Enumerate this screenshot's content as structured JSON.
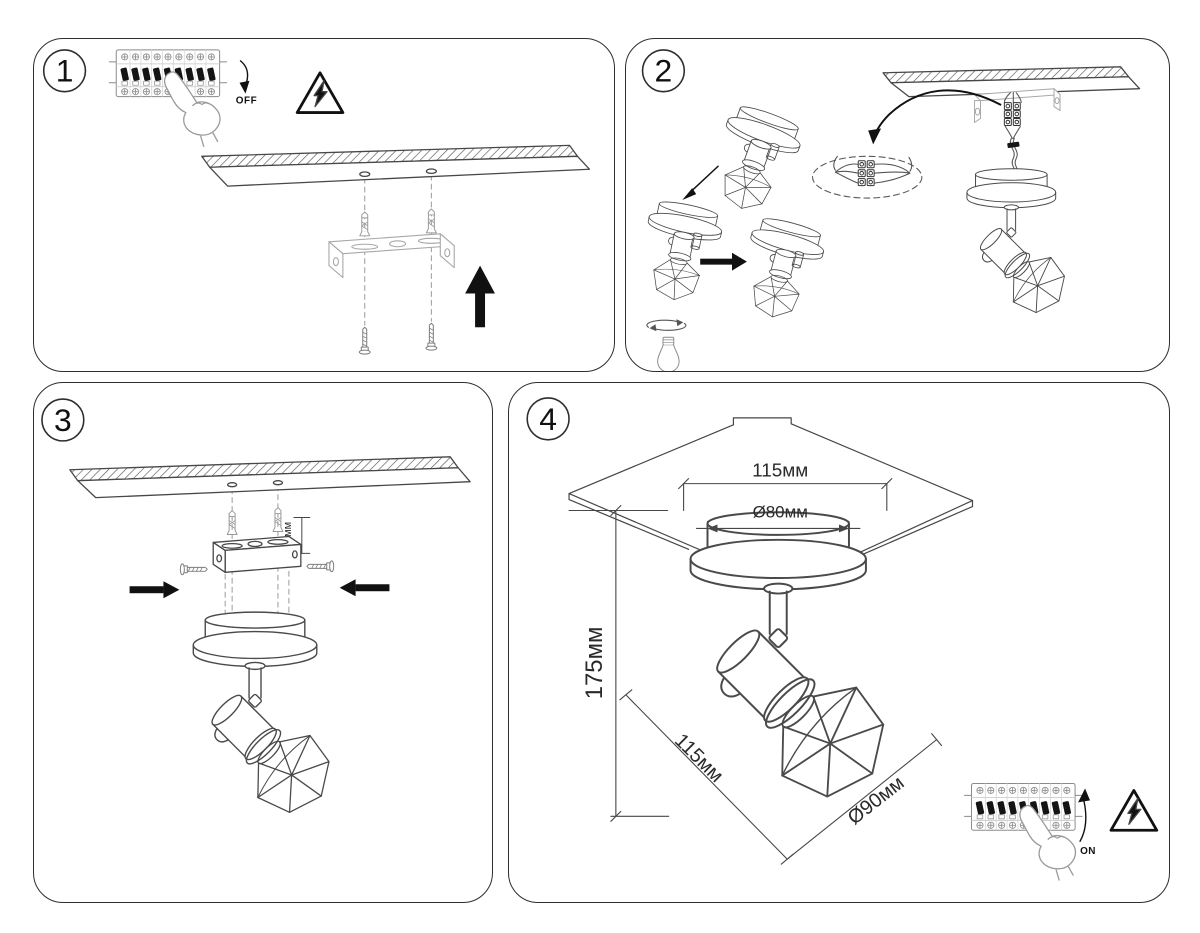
{
  "steps": {
    "step1": {
      "number": "1",
      "power_label": "OFF"
    },
    "step2": {
      "number": "2"
    },
    "step3": {
      "number": "3",
      "bracket_offset": "15мм"
    },
    "step4": {
      "number": "4",
      "mounting_width": "115мм",
      "canopy_diameter": "Ø80мм",
      "fixture_height": "175мм",
      "fixture_projection": "115мм",
      "shade_diameter": "Ø90мм",
      "power_label": "ON"
    }
  },
  "colors": {
    "background": "#ffffff",
    "line": "#474747",
    "line_light": "#9a9a9a",
    "black": "#000000",
    "panel_border": "#2e2e2e"
  }
}
